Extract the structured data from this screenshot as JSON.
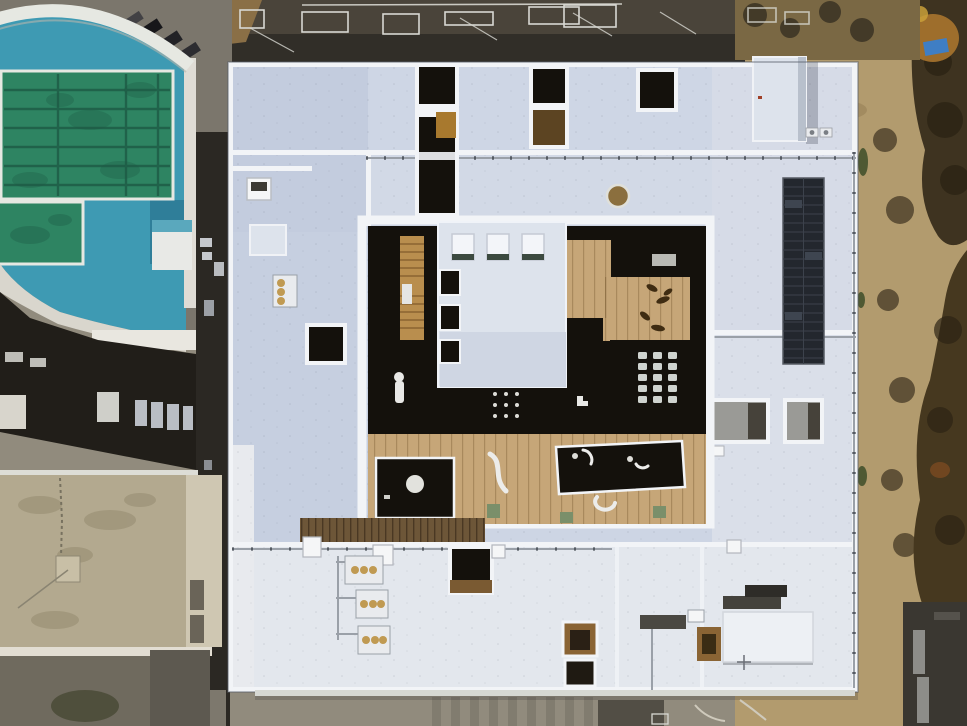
{
  "scene": {
    "type": "aerial-drone-photograph",
    "description": "Top-down aerial view of a large flat white-roofed building with an inner wooden courtyard, rooftop solar array and HVAC units; outdoor swimming pool complex at top-left, dark sports ground along the top, dirt path with autumn trees on the right, neighbouring tan and dark roofs at bottom-left, ground-level pavement at the bottom.",
    "objects": [
      "sports-ground-north",
      "street-northwest",
      "parked-cars",
      "pool-complex",
      "main-pool",
      "kids-pool",
      "pool-building-roof-arc",
      "alley-west",
      "main-building-roof",
      "north-lightwells",
      "ne-penthouse",
      "roof-vent-circle",
      "solar-panel-array",
      "recessed-courts-east",
      "inner-courtyard",
      "courtyard-wood-deck",
      "courtyard-dark-glass",
      "skylight-block",
      "wooden-stair",
      "bench-s-curve",
      "skylight-grid",
      "hvac-cluster-south",
      "stairwell-opening",
      "se-raised-block",
      "neighbor-dark-roof",
      "neighbor-tan-roof",
      "dirt-path-east",
      "trees-east",
      "blue-tarp",
      "dark-building-southeast",
      "ground-strip-south"
    ]
  },
  "palette": {
    "ground": "#918b7d",
    "dirt": "#b29b6e",
    "dirtLight": "#c4ae80",
    "dirtDark": "#8d7850",
    "dirtTop": "#7a6844",
    "treeDark": "#3e3320",
    "treeDarker": "#2c2414",
    "treeOrange": "#a8742e",
    "tarpBlue": "#3f7ec4",
    "field": "#4a443a",
    "fieldShadow": "#312e28",
    "fieldDirt": "#8a6f46",
    "street": "#7b766c",
    "alley": "#2b2823",
    "poolDeck": "#3e9ab3",
    "poolDeckDark": "#2f7e99",
    "poolWater": "#2e8462",
    "poolLane": "#1d5a45",
    "poolEdge": "#e6e8e2",
    "roofBase": "#cdd5e4",
    "roofBright": "#e3e7ed",
    "parapet": "#f2f4f7",
    "penthouse": "#dde3ec",
    "darkGlass": "#14110c",
    "wood": "#c6a678",
    "woodStair": "#b98e4e",
    "woodSlat": "#6d5638",
    "woodDark": "#8a6434",
    "solar": "#23272e",
    "solarLine": "#3c424c",
    "hvac": "#e9ebee",
    "hvacFan": "#c09a52",
    "pipe": "#9aa0a8",
    "courtGray": "#9a9a96",
    "courtDark": "#46423a",
    "tanRoof": "#b3a98f",
    "tanWall": "#cfc7b2",
    "tanStain": "#9b9176",
    "darkRoof": "#211e19",
    "grayUnit": "#b9bdc4",
    "benchGreen": "#7a8f6a",
    "darkBldg": "#3a3731",
    "white": "#f5f6f7"
  }
}
